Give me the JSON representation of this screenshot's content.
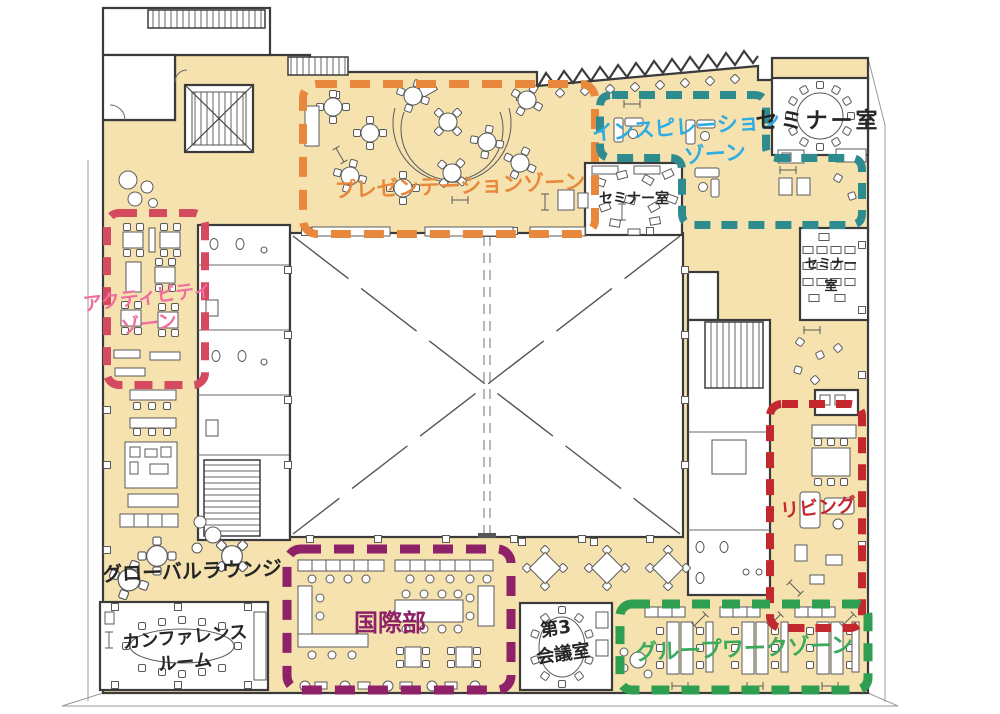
{
  "palette": {
    "floor": "#F5E2AF",
    "wall": "#3B3B3B",
    "furniture": "#5A5A5A",
    "black_text": "#262626",
    "accent_cyan_chair": "#7FD0EA"
  },
  "zones": {
    "presentation": {
      "label": "プレゼンテーションゾーン",
      "color": "#E8883C"
    },
    "inspiration": {
      "line1": "インスピレーション",
      "line2": "ゾーン",
      "border": "#2E8C8F",
      "text": "#2FACE2"
    },
    "activity": {
      "line1": "アクティビティ",
      "line2": "ゾーン",
      "border": "#D64A60",
      "text": "#EF6E9F"
    },
    "living": {
      "label": "リビング",
      "color": "#C3282E"
    },
    "international": {
      "label": "国際部",
      "color": "#8E2167"
    },
    "groupwork": {
      "label": "グループワークゾーン",
      "border": "#2E9E50",
      "text": "#3AAA5C"
    }
  },
  "rooms": {
    "seminar_top_right": {
      "label": "セミナー室"
    },
    "seminar_center": {
      "label": "セミナー室"
    },
    "seminar_right": {
      "line1": "セミナー",
      "line2": "室"
    },
    "global_lounge": {
      "label": "グローバルラウンジ"
    },
    "conference": {
      "line1": "カンファレンス",
      "line2": "ルーム"
    },
    "meeting3": {
      "line1": "第3",
      "line2": "会議室"
    }
  }
}
